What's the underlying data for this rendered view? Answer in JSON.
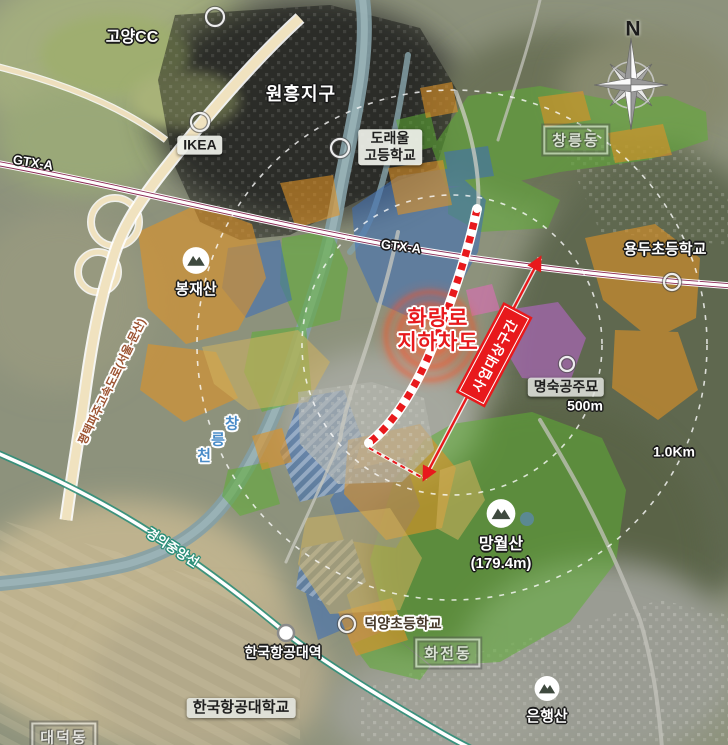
{
  "colors": {
    "accent_red": "#e8191c",
    "zone_orange": "#e09326",
    "zone_yellow": "#d2b25e",
    "zone_green": "#5fae35",
    "zone_blue": "#3f6fb5",
    "zone_purple": "#b665c8",
    "river": "#8aa3a8",
    "gtx_line": "#8b2a55",
    "gyeongui_line": "#2f8f7a",
    "highway_fill": "#f0e2bf"
  },
  "labels": {
    "goyang_cc": "고양CC",
    "wonheung_district": "원흥지구",
    "ikea": "IKEA",
    "doraeul_school_line1": "도래울",
    "doraeul_school_line2": "고등학교",
    "changneung_dong": "창릉동",
    "north": "N",
    "gtx_left": "GTX-A",
    "gtx_center": "GTX-A",
    "bongjae_mountain": "봉재산",
    "highway_name": "평택파주고속도로(서울-문산)",
    "hwarang_line1": "화랑로",
    "hwarang_line2": "지하차도",
    "project_banner": "사업대상구간",
    "yongdu_school": "용두초등학교",
    "myeongsuk_tomb": "명숙공주묘",
    "radius_500m": "500m",
    "radius_1km": "1.0Km",
    "stream_char1": "창",
    "stream_char2": "릉",
    "stream_char3": "천",
    "mangwol_line1": "망월산",
    "mangwol_line2": "(179.4m)",
    "gyeongui_rail": "경의중앙선",
    "kau_station": "한국항공대역",
    "kau_university": "한국항공대학교",
    "deokyang_school": "덕양초등학교",
    "hwajeon_dong": "화전동",
    "eunhaeng_mountain": "은행산",
    "daedeok_dong": "대덕동"
  }
}
